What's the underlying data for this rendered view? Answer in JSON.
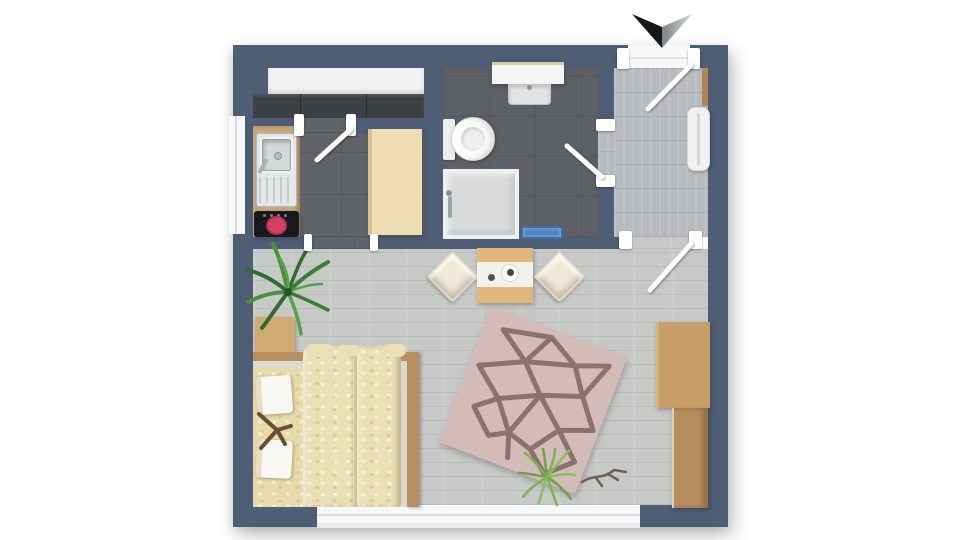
{
  "title": "studio-apartment-floor-plan",
  "colors": {
    "background": "#ffffff",
    "wall": "#4d5e75",
    "kitchen_floor": "#606367",
    "bath_floor": "#5d6064",
    "hall_floor": "#b8bbbd",
    "living_floor": "#c7c9c7",
    "window": "#f7f8f9",
    "counter_white": "#f2f3f4",
    "counter_dark": "#3d4144",
    "counter_wood": "#c8a77b",
    "cabinet_beige": "#eedcb2",
    "sink_steel": "#e4e7e8",
    "cooktop": "#17191d",
    "burner": "#d64062",
    "vanity": "#f4f5f5",
    "basin": "#e2e5e6",
    "toilet": "#fbfcfc",
    "shower": "#d8dadb",
    "bath_mat": "#5081c1",
    "radiator": "#f0f2f2",
    "bed_frame": "#b8905f",
    "bed_duvet": "#ebdfb6",
    "bed_sheet": "#e7daab",
    "pillow": "#f7f7f3",
    "nightstand": "#d0aa73",
    "table": "#e2b77b",
    "runner": "#f3f1ec",
    "chair": "#efe9da",
    "rug": "#d3bbb7",
    "rug_pattern": "#8a726e",
    "plant_dark": "#39783a",
    "plant_mid": "#4d9542",
    "plant_light": "#7fb254",
    "twig": "#6f6052",
    "desk": "#c79e68",
    "wardrobe": "#b78e5e",
    "door_leaf": "#ffffff",
    "north_black": "#161616",
    "north_gray": "#a7adaf"
  },
  "rooms": [
    {
      "id": "kitchen",
      "floor": "dark-tile"
    },
    {
      "id": "bathroom",
      "floor": "dark-tile"
    },
    {
      "id": "hallway",
      "floor": "light-wood"
    },
    {
      "id": "living-area",
      "floor": "light-wood"
    }
  ],
  "fixtures": {
    "kitchen": [
      "white-counter-run",
      "dark-counter-run",
      "sink-unit",
      "cooktop-with-burner",
      "tall-cabinet"
    ],
    "bathroom": [
      "vanity-with-basin",
      "toilet",
      "shower-enclosure",
      "bath-mat"
    ],
    "hallway": [
      "entrance-door",
      "radiator"
    ],
    "living": [
      "double-bed",
      "pillows",
      "nightstand",
      "dining-table",
      "two-chairs",
      "geometric-rug",
      "palm-plant",
      "grass-plant",
      "decor-twig",
      "desk",
      "wardrobe"
    ]
  },
  "openings": {
    "doors": [
      "entrance-door",
      "bathroom-door",
      "hallway-living-door",
      "kitchen-strip-door",
      "kitchen-passage"
    ],
    "windows": [
      "left-wall-window",
      "bottom-wall-window"
    ]
  },
  "compass": {
    "north_arrow": "pointing-down"
  }
}
